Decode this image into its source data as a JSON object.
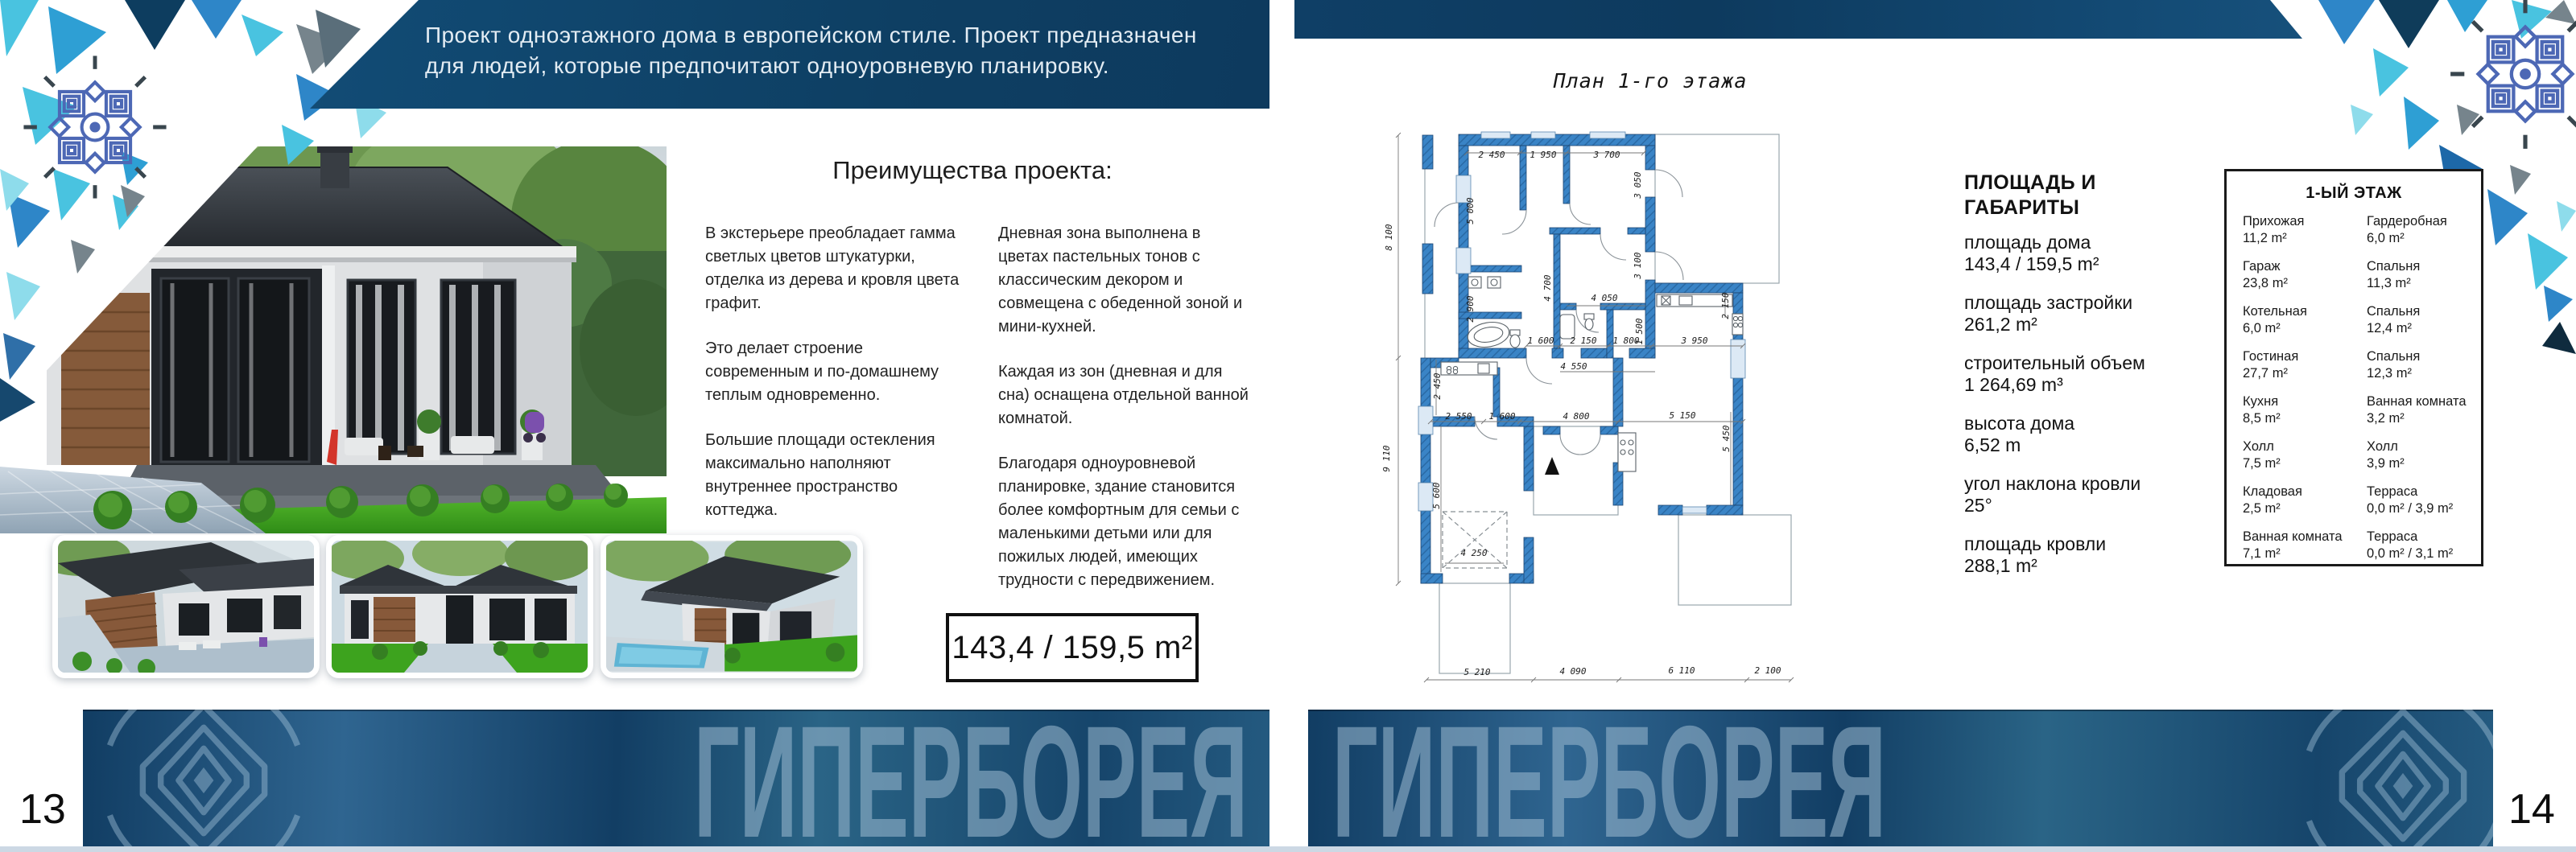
{
  "left": {
    "page_number": "13",
    "header": {
      "line1": "Проект одноэтажного дома в европейском стиле. Проект предназначен",
      "line2": "для людей, которые предпочитают одноуровневую планировку."
    },
    "advantages": {
      "title": "Преимущества проекта:",
      "col1": [
        "В экстерьере преобладает гамма светлых цветов штукатурки, отделка из дерева и кровля цвета графит.",
        "Это делает строение современным и по-домашнему теплым одновременно.",
        "Большие площади остекления максимально наполняют внутреннее пространство коттеджа."
      ],
      "col2": [
        "Дневная зона выполнена в цветах пастельных тонов с классическим декором и совмещена с обеденной зоной и мини-кухней.",
        "Каждая из зон (дневная и для сна) оснащена отдельной ванной комнатой.",
        "Благодаря одноуровневой планировке, здание становится более комфортным для семьи с маленькими детьми или для пожилых людей, имеющих трудности с передвижением."
      ]
    },
    "area_box": "143,4 / 159,5 m²"
  },
  "right": {
    "page_number": "14",
    "plan": {
      "title": "План 1-го этажа",
      "dims": [
        "2 450",
        "1 950",
        "3 700",
        "5 000",
        "3 050",
        "4 700",
        "3 100",
        "4 050",
        "2 900",
        "1 500",
        "1 600",
        "2 150",
        "1 800",
        "3 950",
        "2 150",
        "4 550",
        "2 450",
        "2 550",
        "1 600",
        "4 800",
        "5 150",
        "8 100",
        "9 110",
        "5 600",
        "4 250",
        "5 450",
        "5 210",
        "4 090",
        "6 110",
        "2 100"
      ]
    },
    "specs": {
      "heading_line1": "ПЛОЩАДЬ И",
      "heading_line2": "ГАБАРИТЫ",
      "items": [
        {
          "label": "площадь дома",
          "value": "143,4 / 159,5 m²"
        },
        {
          "label": "площадь застройки",
          "value": "261,2 m²"
        },
        {
          "label": "строительный объем",
          "value": "1 264,69 m³"
        },
        {
          "label": "высота дома",
          "value": "6,52 m"
        },
        {
          "label": "угол наклона кровли",
          "value": "25°"
        },
        {
          "label": "площадь кровли",
          "value": "288,1 m²"
        }
      ]
    },
    "rooms": {
      "title": "1-ЫЙ ЭТАЖ",
      "rows": [
        {
          "l_name": "Прихожая",
          "l_val": "11,2 m²",
          "r_name": "Гардеробная",
          "r_val": "6,0 m²"
        },
        {
          "l_name": "Гараж",
          "l_val": "23,8 m²",
          "r_name": "Спальня",
          "r_val": "11,3 m²"
        },
        {
          "l_name": "Котельная",
          "l_val": "6,0 m²",
          "r_name": "Спальня",
          "r_val": "12,4 m²"
        },
        {
          "l_name": "Гостиная",
          "l_val": "27,7 m²",
          "r_name": "Спальня",
          "r_val": "12,3 m²"
        },
        {
          "l_name": "Кухня",
          "l_val": "8,5 m²",
          "r_name": "Ванная комната",
          "r_val": "3,2 m²"
        },
        {
          "l_name": "Холл",
          "l_val": "7,5 m²",
          "r_name": "Холл",
          "r_val": "3,9 m²"
        },
        {
          "l_name": "Кладовая",
          "l_val": "2,5 m²",
          "r_name": "Терраса",
          "r_val": "0,0 m² / 3,9 m²"
        },
        {
          "l_name": "Ванная комната",
          "l_val": "7,1 m²",
          "r_name": "Терраса",
          "r_val": "0,0 m² / 3,1 m²"
        }
      ]
    }
  },
  "footer": {
    "brand_left": "ГИПЕРБОРЕЯ",
    "brand_right": "ГИПЕРБОРЕЯ"
  },
  "colors": {
    "header_band": "#11466e",
    "top_bar": "#0f3f66",
    "footer_banner_deep": "#113d63",
    "footer_banner_light": "#2f6590",
    "brand_letters": "#9fc0d6",
    "plan_walls": "#3a84c6",
    "triangle_blue": "#2e86c8",
    "triangle_cyan": "#49c3e0",
    "triangle_navy": "#0f3c5a",
    "triangle_gray": "#76848c",
    "mandala_blue": "#4d68b5",
    "bottom_strip": "#ccd8e4"
  }
}
